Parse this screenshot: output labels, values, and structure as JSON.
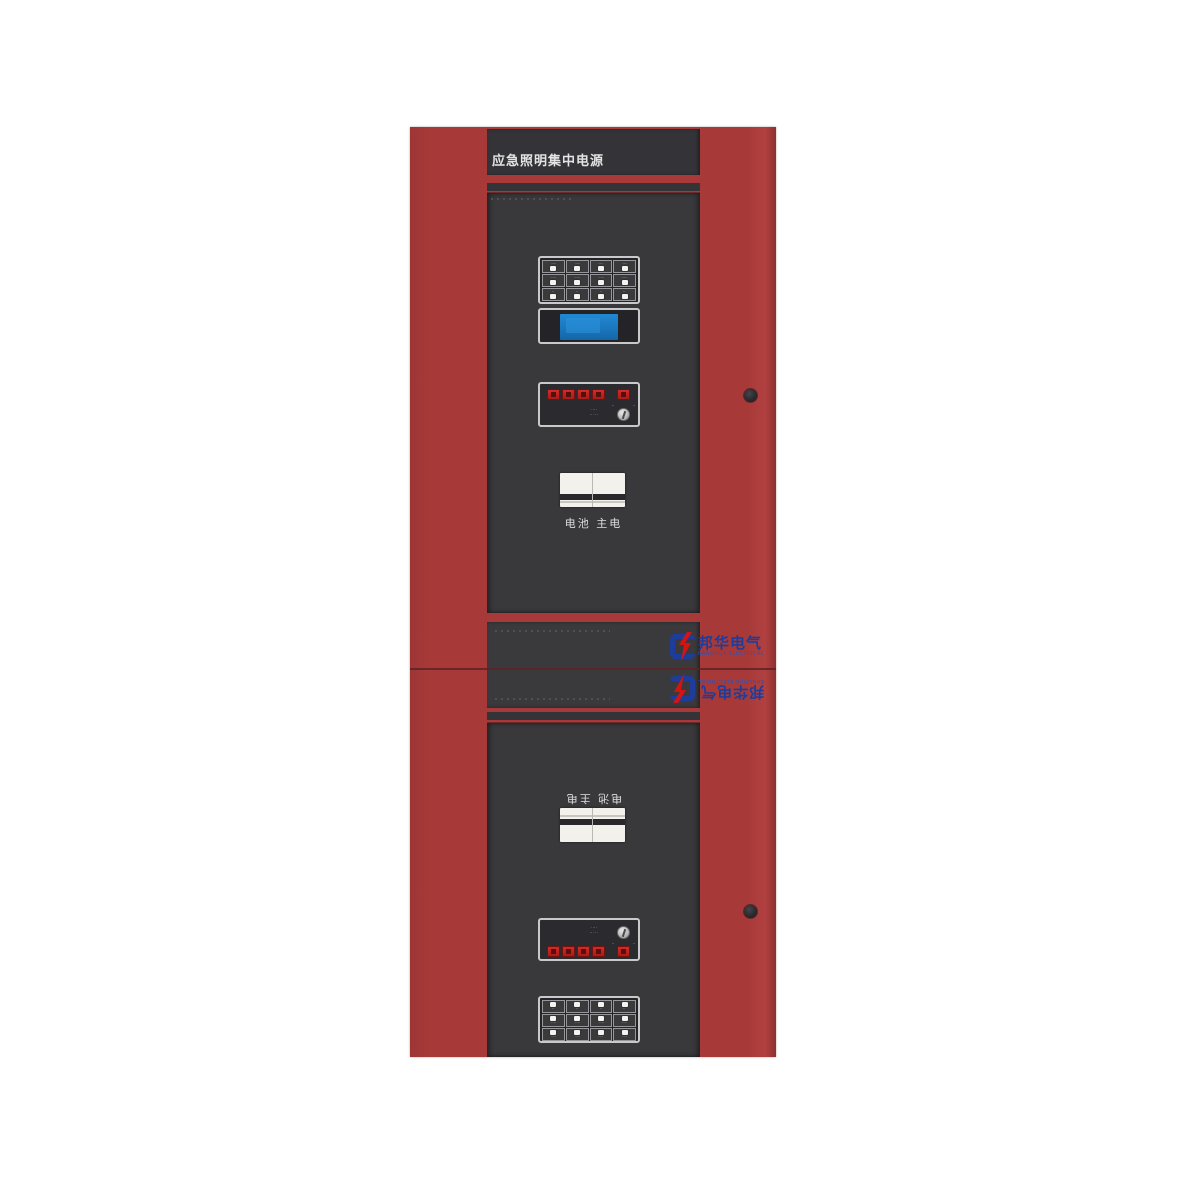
{
  "header": {
    "title": "应急照明集中电源"
  },
  "brand": {
    "logo_cn": "邦华电气",
    "logo_en": "BANGHUA ELECTRICAL"
  },
  "colors": {
    "cabinet_red": "#a73a39",
    "panel_dark": "#39383b",
    "lcd_blue": "#1b77bf",
    "indicator_red": "#c32222",
    "logo_blue": "#1e3d9b"
  },
  "upper_unit": {
    "switch_label": "电池  主电",
    "grid_labels": [
      "····",
      "····",
      "····",
      "····",
      "·····",
      "·····",
      "·····",
      "·····",
      "··",
      "··",
      "··",
      "··"
    ],
    "key_panel": {
      "text_line1": "· ·· ·",
      "text_line2": "·· ·· ·",
      "knob_left": "··",
      "knob_right": "··"
    }
  },
  "lower_unit": {
    "switch_label": "电池  主电",
    "grid_labels": [
      "··",
      "··",
      "··",
      "··",
      "·····",
      "·····",
      "·····",
      "·····",
      "····",
      "····",
      "····",
      "····"
    ],
    "key_panel": {
      "text_line1": "· ·· ·",
      "text_line2": "·· ·· ·",
      "knob_left": "··",
      "knob_right": "··"
    }
  }
}
